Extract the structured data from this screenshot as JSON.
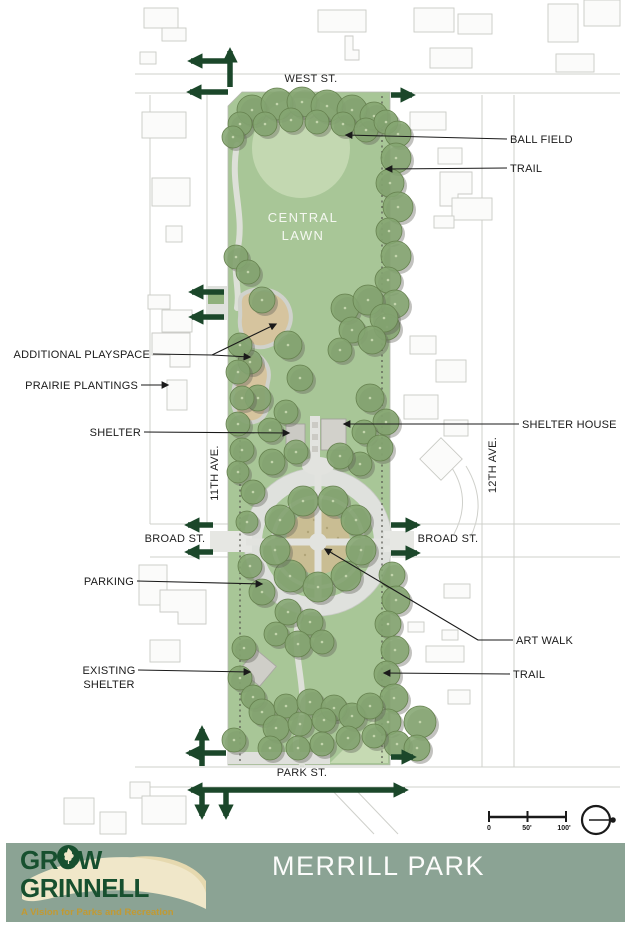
{
  "map": {
    "streets": {
      "west": "WEST ST.",
      "park": "PARK ST.",
      "broad_left": "BROAD ST.",
      "broad_right": "BROAD ST.",
      "ave_11": "11TH AVE.",
      "ave_12": "12TH AVE."
    },
    "areas": {
      "central_lawn_line1": "CENTRAL",
      "central_lawn_line2": "LAWN"
    },
    "callouts": {
      "ball_field": "BALL FIELD",
      "trail_upper": "TRAIL",
      "shelter_house": "SHELTER HOUSE",
      "art_walk": "ART WALK",
      "trail_lower": "TRAIL",
      "additional_playspace": "ADDITIONAL PLAYSPACE",
      "prairie_plantings": "PRAIRIE PLANTINGS",
      "shelter": "SHELTER",
      "parking": "PARKING",
      "existing_shelter_line1": "EXISTING",
      "existing_shelter_line2": "SHELTER"
    },
    "scale_bar": {
      "tick_0": "0",
      "tick_50": "50'",
      "tick_100": "100'"
    },
    "colors": {
      "park_green": "#a8c697",
      "ball_field_green": "#c3d8b1",
      "tree_green": "#84a571",
      "playspace_tan": "#d6c49e",
      "art_walk_tan": "#c9bd93",
      "plaza_gray": "#dfe1dd",
      "trail_arrow_green": "#1b472a",
      "footer_sage": "#8ba394",
      "logo_green": "#17502f",
      "logo_gold": "#c19a33",
      "logo_cream": "#f0e7c9"
    },
    "trees": [
      [
        252,
        110,
        15
      ],
      [
        277,
        104,
        16
      ],
      [
        302,
        102,
        15
      ],
      [
        327,
        106,
        16
      ],
      [
        352,
        110,
        15
      ],
      [
        374,
        116,
        14
      ],
      [
        240,
        124,
        12
      ],
      [
        265,
        124,
        12
      ],
      [
        291,
        120,
        12
      ],
      [
        317,
        122,
        12
      ],
      [
        343,
        124,
        12
      ],
      [
        366,
        130,
        12
      ],
      [
        386,
        122,
        12
      ],
      [
        398,
        134,
        13
      ],
      [
        233,
        137,
        11
      ],
      [
        396,
        158,
        15
      ],
      [
        390,
        183,
        14
      ],
      [
        398,
        207,
        15
      ],
      [
        389,
        231,
        13
      ],
      [
        396,
        256,
        15
      ],
      [
        388,
        280,
        13
      ],
      [
        395,
        304,
        14
      ],
      [
        387,
        327,
        13
      ],
      [
        236,
        257,
        12
      ],
      [
        248,
        272,
        12
      ],
      [
        262,
        300,
        13
      ],
      [
        288,
        345,
        14
      ],
      [
        250,
        362,
        12
      ],
      [
        300,
        378,
        13
      ],
      [
        258,
        398,
        13
      ],
      [
        286,
        412,
        12
      ],
      [
        270,
        430,
        12
      ],
      [
        345,
        308,
        14
      ],
      [
        368,
        300,
        15
      ],
      [
        384,
        318,
        14
      ],
      [
        352,
        330,
        13
      ],
      [
        372,
        340,
        14
      ],
      [
        340,
        350,
        12
      ],
      [
        240,
        345,
        12
      ],
      [
        238,
        372,
        12
      ],
      [
        242,
        398,
        12
      ],
      [
        238,
        424,
        12
      ],
      [
        242,
        450,
        12
      ],
      [
        370,
        398,
        14
      ],
      [
        386,
        422,
        13
      ],
      [
        364,
        432,
        12
      ],
      [
        380,
        448,
        13
      ],
      [
        360,
        464,
        12
      ],
      [
        272,
        462,
        13
      ],
      [
        296,
        452,
        12
      ],
      [
        340,
        456,
        13
      ],
      [
        238,
        472,
        11
      ],
      [
        290,
        576,
        16
      ],
      [
        275,
        550,
        15
      ],
      [
        280,
        520,
        15
      ],
      [
        303,
        501,
        15
      ],
      [
        333,
        501,
        15
      ],
      [
        356,
        520,
        15
      ],
      [
        361,
        550,
        15
      ],
      [
        346,
        576,
        15
      ],
      [
        318,
        587,
        15
      ],
      [
        253,
        492,
        12
      ],
      [
        247,
        522,
        11
      ],
      [
        250,
        566,
        12
      ],
      [
        262,
        592,
        13
      ],
      [
        288,
        612,
        13
      ],
      [
        310,
        622,
        13
      ],
      [
        276,
        634,
        12
      ],
      [
        298,
        644,
        13
      ],
      [
        322,
        642,
        12
      ],
      [
        392,
        575,
        13
      ],
      [
        396,
        600,
        14
      ],
      [
        388,
        624,
        13
      ],
      [
        395,
        650,
        14
      ],
      [
        387,
        674,
        13
      ],
      [
        394,
        698,
        14
      ],
      [
        388,
        722,
        13
      ],
      [
        397,
        744,
        13
      ],
      [
        244,
        648,
        12
      ],
      [
        240,
        678,
        12
      ],
      [
        253,
        697,
        12
      ],
      [
        262,
        712,
        13
      ],
      [
        286,
        706,
        12
      ],
      [
        310,
        702,
        13
      ],
      [
        334,
        708,
        13
      ],
      [
        276,
        728,
        13
      ],
      [
        300,
        724,
        12
      ],
      [
        324,
        720,
        12
      ],
      [
        352,
        716,
        13
      ],
      [
        370,
        706,
        13
      ],
      [
        298,
        748,
        12
      ],
      [
        322,
        744,
        12
      ],
      [
        270,
        748,
        12
      ],
      [
        348,
        738,
        12
      ],
      [
        374,
        736,
        12
      ],
      [
        420,
        722,
        16
      ],
      [
        417,
        748,
        13
      ],
      [
        234,
        740,
        12
      ]
    ],
    "trail_arrows": [
      {
        "p": "230,87 230,51"
      },
      {
        "p": "230,61 191,61"
      },
      {
        "p": "228,92 190,92"
      },
      {
        "p": "391,95 412,95"
      },
      {
        "p": "224,292 192,292"
      },
      {
        "p": "224,317 192,317"
      },
      {
        "p": "213,525 188,525"
      },
      {
        "p": "213,552 188,552"
      },
      {
        "p": "391,525 417,525"
      },
      {
        "p": "391,553 417,553"
      },
      {
        "p": "202,766 202,729"
      },
      {
        "p": "226,753 189,753"
      },
      {
        "p": "391,757 413,757"
      },
      {
        "p": "191,790 405,790",
        "both": true
      },
      {
        "p": "202,790 202,816"
      },
      {
        "p": "226,790 226,816"
      }
    ]
  },
  "footer": {
    "title": "MERRILL PARK",
    "logo_line1": "GROW",
    "logo_line2": "GRINNELL",
    "tagline": "A Vision for Parks and Recreation"
  }
}
